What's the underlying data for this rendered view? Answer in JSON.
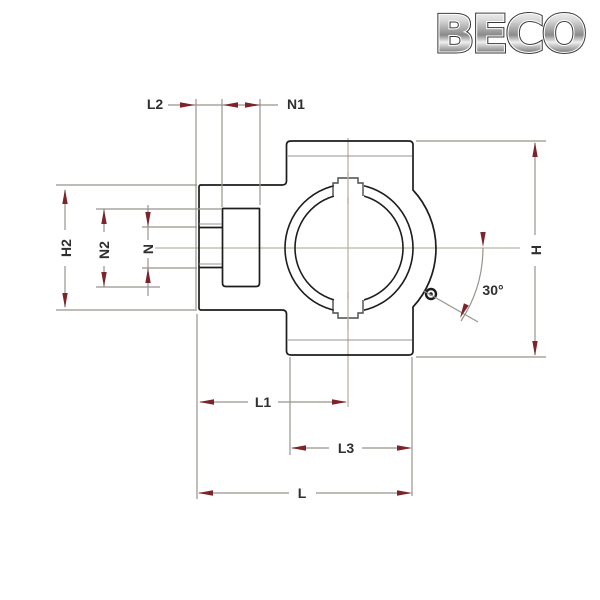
{
  "logo": {
    "text": "BECO"
  },
  "dimensions": {
    "L2": "L2",
    "N1": "N1",
    "H2": "H2",
    "N2": "N2",
    "N": "N",
    "H": "H",
    "L1": "L1",
    "L3": "L3",
    "L": "L",
    "angle": "30°"
  },
  "colors": {
    "outline": "#1d1d1d",
    "dimension_line": "#98948c",
    "centerline": "#b9b4a6",
    "arrow": "#7c2429",
    "label_text": "#2f2f2f"
  }
}
